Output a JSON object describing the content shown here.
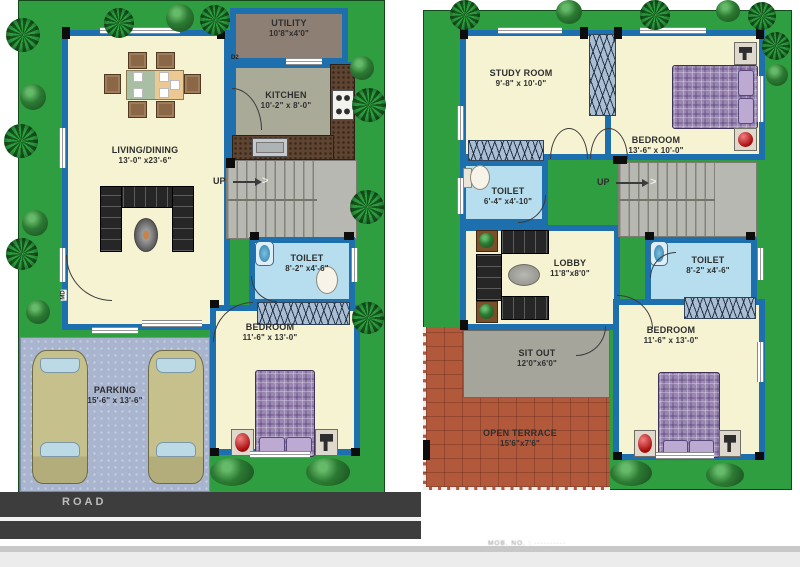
{
  "colors": {
    "lawn": "#2f9e41",
    "wall": "#1e6fad",
    "room": "#f6f3d2",
    "toilet": "#b6deee",
    "kfloor": "#a9ab98",
    "ufloor": "#8d7f74",
    "counter": "#5e4431",
    "stairs": "#b8b8b2",
    "sitout": "#a5a59b",
    "terrace": "#b2593c",
    "parking": "#a9b4ce",
    "road": "#3d3d3d",
    "bed": "#9c87b5",
    "car": "#c6c18c",
    "sofa": "#262626"
  },
  "ground_floor": {
    "living": {
      "name": "LIVING/DINING",
      "dim": "13'-0\" x23'-6\""
    },
    "utility": {
      "name": "UTILITY",
      "dim": "10'8\"x4'0\""
    },
    "kitchen": {
      "name": "KITCHEN",
      "dim": "10'-2\" x 8'-0\""
    },
    "toilet": {
      "name": "TOILET",
      "dim": "8'-2\" x4'-6\""
    },
    "bedroom": {
      "name": "BEDROOM",
      "dim": "11'-6\" x 13'-0\""
    },
    "parking": {
      "name": "PARKING",
      "dim": "15'-6\" x 13'-6\""
    },
    "up": "UP",
    "md": "MD",
    "d2": "D2"
  },
  "first_floor": {
    "study": {
      "name": "STUDY ROOM",
      "dim": "9'-8\" x 10'-0\""
    },
    "bedroom1": {
      "name": "BEDROOM",
      "dim": "13'-6\" x 10'-0\""
    },
    "toilet1": {
      "name": "TOILET",
      "dim": "6'-4\" x4'-10\""
    },
    "lobby": {
      "name": "LOBBY",
      "dim": "11'8\"x8'0\""
    },
    "toilet2": {
      "name": "TOILET",
      "dim": "8'-2\" x4'-6\""
    },
    "sitout": {
      "name": "SIT OUT",
      "dim": "12'0\"x6'0\""
    },
    "terrace": {
      "name": "OPEN TERRACE",
      "dim": "15'6\"x7'6\""
    },
    "bedroom2": {
      "name": "BEDROOM",
      "dim": "11'-6\" x 13'-0\""
    },
    "up": "UP"
  },
  "road_label": "ROAD",
  "footer_note": "MOB. NO. : ··········"
}
